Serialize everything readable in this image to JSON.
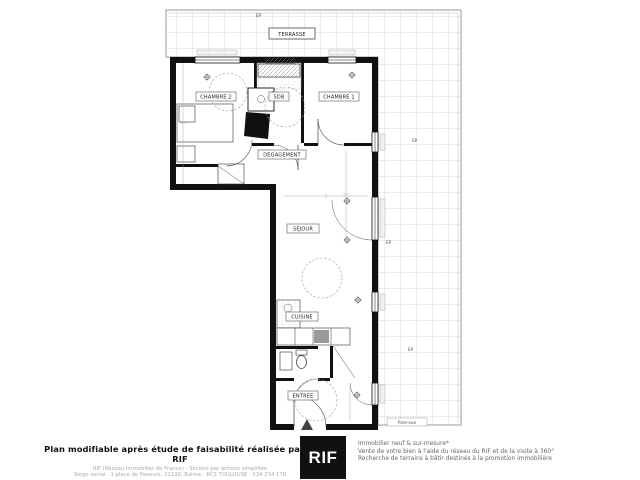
{
  "plan": {
    "terrace_label": "TERRASSE",
    "rooms": {
      "chambre2": "CHAMBRE 2",
      "sdb": "SDB",
      "chambre1": "CHAMBRE 1",
      "degagement": "DEGAGEMENT",
      "sejour": "SEJOUR",
      "cuisine": "CUISINE",
      "entree": "ENTREE"
    },
    "annotations": {
      "ep": "EP",
      "pare_vue": "Pare-vue"
    }
  },
  "footer": {
    "left": {
      "title": "Plan modifiable après étude de faisabilité réalisée par le RIF",
      "line1": "RIF (Réseau Immobilier de France) - Société par actions simplifiée",
      "line2": "Siège social : 1 place de Paveurs, 31130, Balma - RCS TOULOUSE : 534 234 178"
    },
    "logo_text": "RIF",
    "right": {
      "line1": "Immobilier neuf & sur-mesure*",
      "line2": "Vente de votre bien à l'aide du réseau du RIF et de la visite à 360°",
      "line3": "Recherche de terrains à bâtir destinés à la promotion immobilière"
    }
  },
  "colors": {
    "wall": "#111111",
    "tile_line": "#cccccc",
    "logo_bg": "#111111",
    "appliance_gray": "#9a9a9a"
  }
}
